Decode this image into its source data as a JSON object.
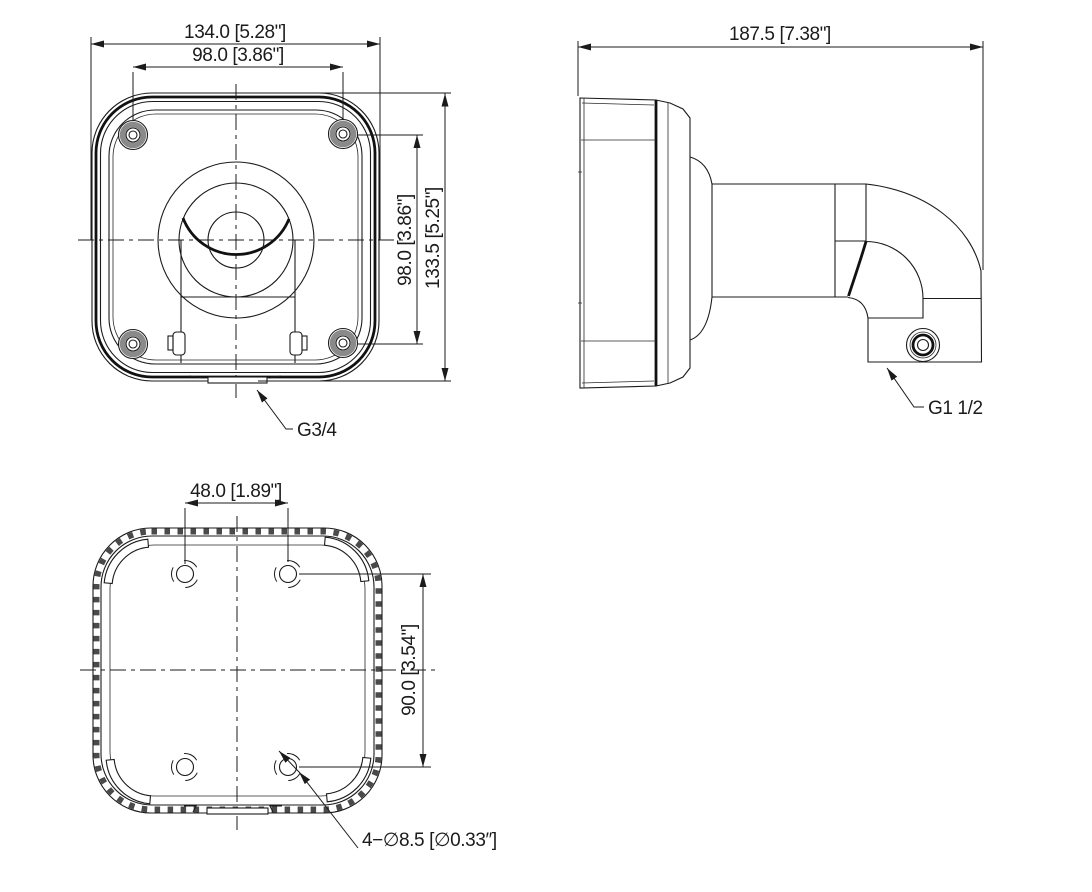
{
  "drawing": {
    "title": "wall-mount-bracket-dimension-drawing",
    "colors": {
      "line": "#1b1b1b",
      "background": "#ffffff",
      "hatch": "#4a4a4a",
      "screw_ring": "#8a8a8a"
    },
    "views": {
      "front": {
        "dim_overall_width": "134.0 [5.28\"]",
        "dim_hole_width": "98.0 [3.86\"]",
        "dim_hole_height": "98.0 [3.86\"]",
        "dim_overall_height": "133.5 [5.25\"]",
        "thread_label": "G3/4"
      },
      "side": {
        "dim_overall_depth": "187.5 [7.38\"]",
        "thread_label": "G1 1/2"
      },
      "bottom": {
        "dim_hole_spacing_horizontal": "48.0 [1.89\"]",
        "dim_hole_spacing_vertical": "90.0 [3.54\"]",
        "hole_label": "4−∅8.5 [∅0.33″]"
      }
    }
  }
}
